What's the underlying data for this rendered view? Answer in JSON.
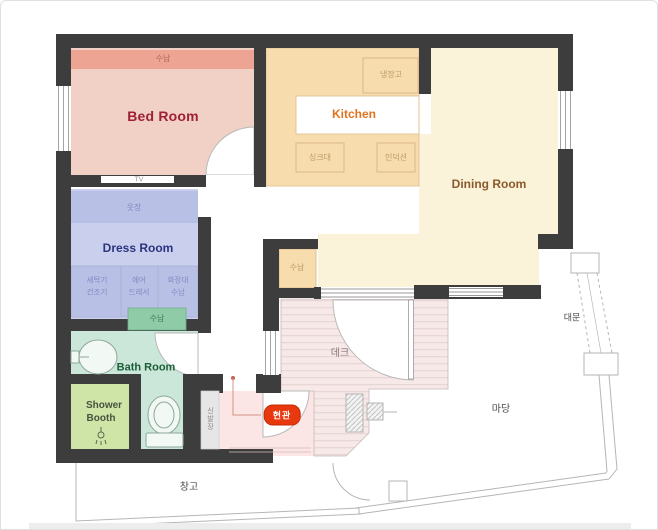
{
  "colors": {
    "wall": "#3d3d3d",
    "bedroom": "#f1d0c6",
    "bedroom_accent": "#eda492",
    "bedroom_text": "#9e2033",
    "kitchen": "#f7dcae",
    "kitchen_text": "#e0731d",
    "kitchen_box_text": "#bd9a66",
    "dining": "#faf3d9",
    "dining_text": "#8a5a2a",
    "dress": "#c9cfec",
    "dress_accent": "#b9c0e5",
    "dress_text": "#2b3480",
    "bath": "#cbe7d9",
    "bath_accent": "#90cba8",
    "bath_text": "#1c5e38",
    "shower": "#cfe5a8",
    "deck": "#f6e9e8",
    "deck_text": "#8d7676",
    "entrance": "#fbe5e5",
    "entrance_badge": "#e8380d",
    "outdoor_line": "#b5b5b5"
  },
  "rooms": {
    "bedroom": {
      "name": "Bed Room",
      "storage_label": "수납",
      "tv_label": "TV"
    },
    "kitchen": {
      "name": "Kitchen",
      "fridge_label": "냉장고",
      "sink_label": "싱크대",
      "induction_label": "인덕션"
    },
    "dining": {
      "name": "Dining Room"
    },
    "dress_room": {
      "name": "Dress Room",
      "closet_label": "옷장",
      "box1_line1": "세탁기",
      "box1_line2": "건조기",
      "box2_line1": "에어",
      "box2_line2": "드레서",
      "box3_line1": "화장대",
      "box3_line2": "수납"
    },
    "bathroom": {
      "name": "Bath Room",
      "storage_label": "수납"
    },
    "shower": {
      "line1": "Shower",
      "line2": "Booth"
    },
    "hallway_storage": {
      "label": "수납"
    },
    "deck": {
      "name": "데크"
    },
    "entrance": {
      "badge": "현관",
      "shoe_cabinet": "신발장"
    }
  },
  "outdoor": {
    "yard": "마당",
    "gate": "대문",
    "shed": "창고"
  }
}
